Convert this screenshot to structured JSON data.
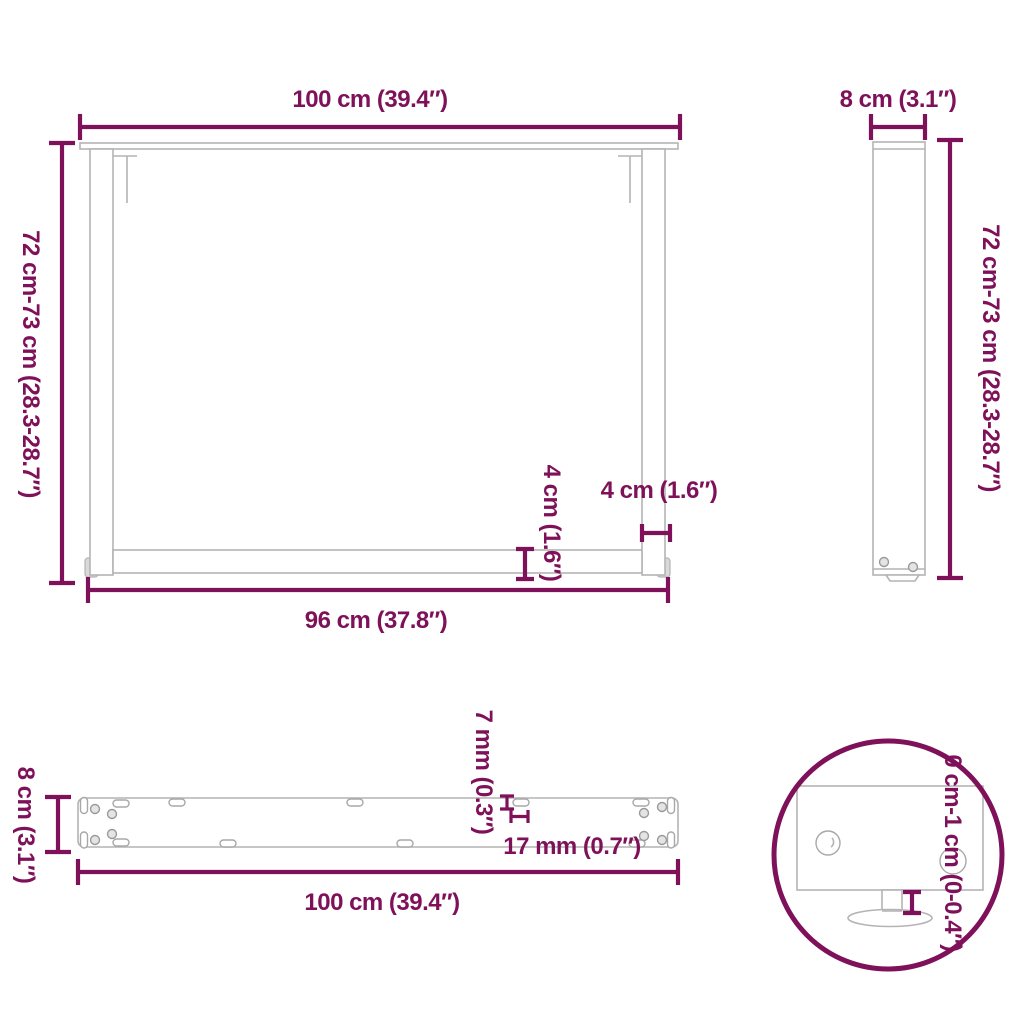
{
  "colors": {
    "accent": "#7E1159",
    "line_art": "#b4b4b4"
  },
  "views": {
    "front_view": {
      "top_width": "100 cm (39.4″)",
      "height_range": "72 cm-73 cm (28.3-28.7″)",
      "bottom_inner_width": "96 cm (37.8″)",
      "crossbar_thickness": "4 cm (1.6″)",
      "leg_thickness": "4 cm (1.6″)"
    },
    "side_view": {
      "depth": "8 cm (3.1″)",
      "height_range": "72 cm-73 cm (28.3-28.7″)"
    },
    "mounting_plate_view": {
      "plate_depth": "8 cm (3.1″)",
      "screw_hole_diameter": "7 mm (0.3″)",
      "slot_length": "17 mm (0.7″)",
      "plate_length": "100 cm (39.4″)"
    },
    "foot_detail_view": {
      "height_adjustment_range": "0 cm-1 cm (0-0.4″)"
    }
  }
}
